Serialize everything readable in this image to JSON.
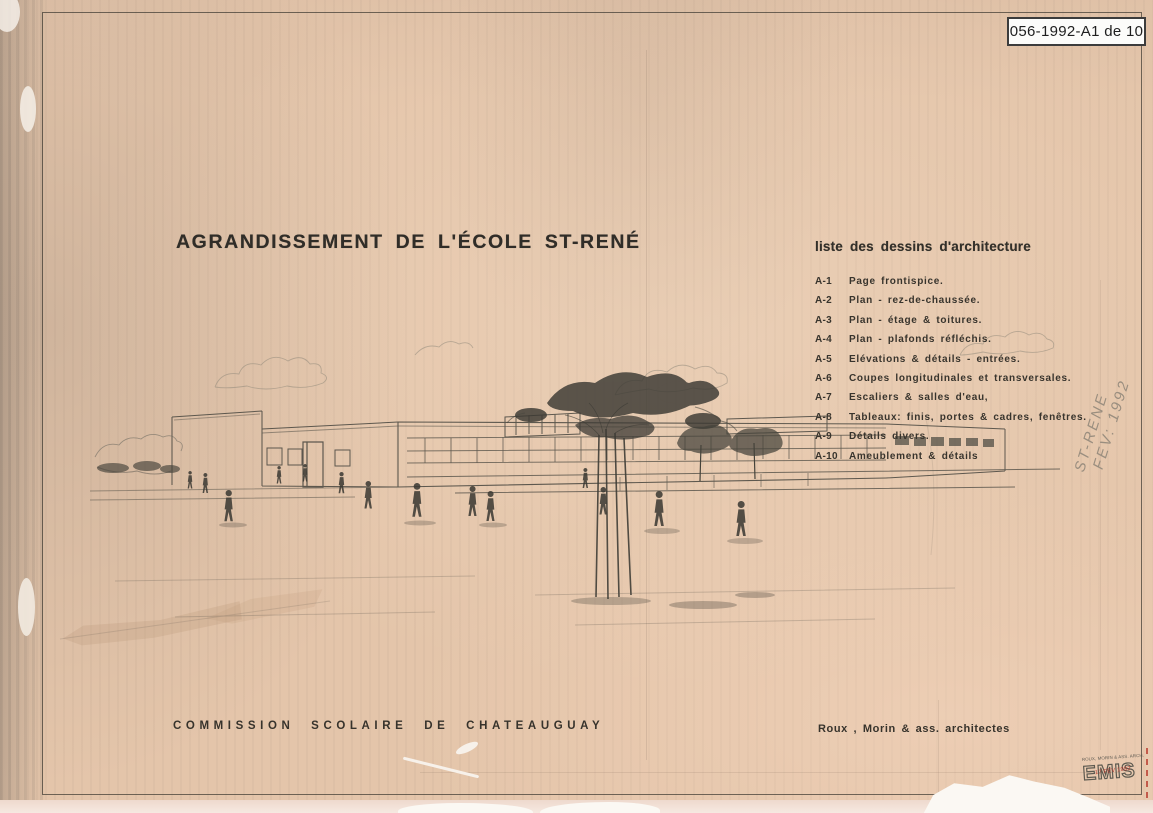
{
  "page": {
    "label": "056-1992-A1 de 10"
  },
  "title": {
    "text": "AGRANDISSEMENT DE L'ÉCOLE ST-RENÉ"
  },
  "drawing_list": {
    "heading": "liste des dessins d'architecture",
    "items": [
      {
        "code": "A-1",
        "label": "Page frontispice."
      },
      {
        "code": "A-2",
        "label": "Plan - rez-de-chaussée."
      },
      {
        "code": "A-3",
        "label": "Plan - étage & toitures."
      },
      {
        "code": "A-4",
        "label": "Plan - plafonds réfléchis."
      },
      {
        "code": "A-5",
        "label": "Elévations & détails - entrées."
      },
      {
        "code": "A-6",
        "label": "Coupes longitudinales et transversales."
      },
      {
        "code": "A-7",
        "label": "Escaliers & salles d'eau,"
      },
      {
        "code": "A-8",
        "label": "Tableaux: finis, portes & cadres, fenêtres."
      },
      {
        "code": "A-9",
        "label": "Détails divers."
      },
      {
        "code": "A-10",
        "label": "Ameublement & détails"
      }
    ]
  },
  "footer": {
    "client": "COMMISSION SCOLAIRE DE CHATEAUGUAY",
    "architects": "Roux , Morin & ass.  architectes"
  },
  "annotations": {
    "handwritten_line1": "ST-RENE",
    "handwritten_line2": "FEV: 1992",
    "stamp_firm": "ROUX, MORIN & ASS. ARCH.",
    "stamp_word": "EMIS",
    "stamp_date": "17 FEV 1992"
  },
  "colors": {
    "paper": "#e4c5aa",
    "ink": "#35322c",
    "pencil": "#55524a",
    "stamp_red": "#b5342a",
    "label_bg": "#fcfcfa"
  }
}
